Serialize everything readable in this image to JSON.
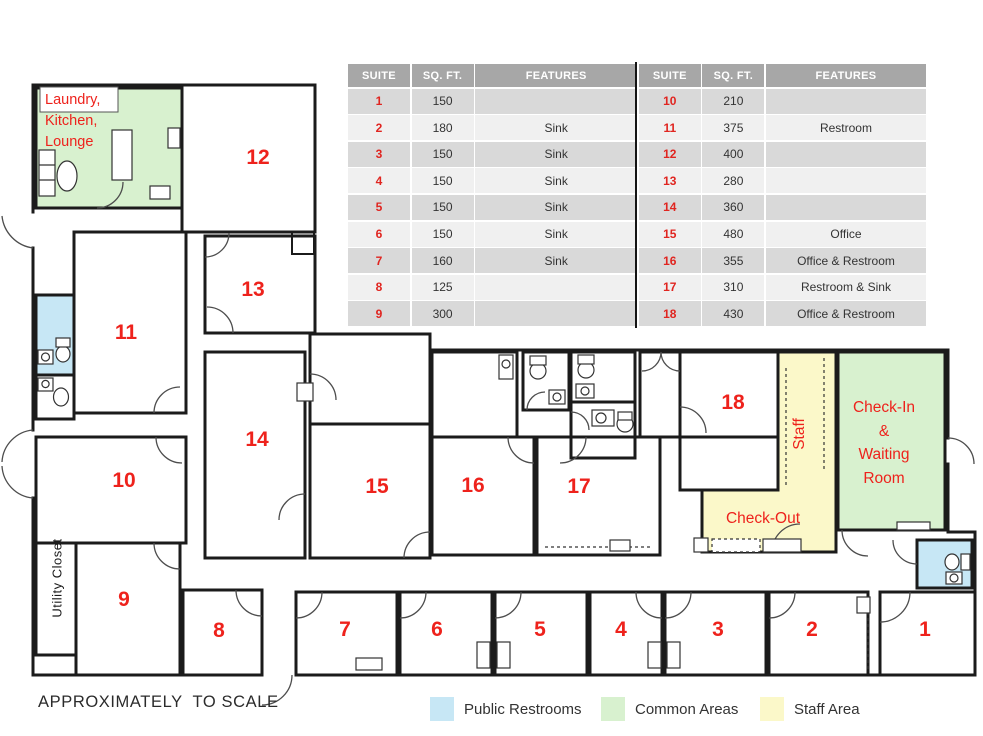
{
  "plan": {
    "suites": {
      "s1": "1",
      "s2": "2",
      "s3": "3",
      "s4": "4",
      "s5": "5",
      "s6": "6",
      "s7": "7",
      "s8": "8",
      "s9": "9",
      "s10": "10",
      "s11": "11",
      "s12": "12",
      "s13": "13",
      "s14": "14",
      "s15": "15",
      "s16": "16",
      "s17": "17",
      "s18": "18"
    },
    "labels": {
      "common_room_lines": [
        "Laundry,",
        "Kitchen,",
        "Lounge"
      ],
      "check_in_lines": [
        "Check-In",
        "&",
        "Waiting",
        "Room"
      ],
      "check_out": "Check-Out",
      "staff": "Staff",
      "utility_closet": "Utility Closet"
    },
    "footer_note": "APPROXIMATELY  TO SCALE"
  },
  "suite_table": {
    "headers": [
      "SUITE",
      "SQ. FT.",
      "FEATURES"
    ],
    "left_rows": [
      {
        "suite": "1",
        "sqft": "150",
        "features": ""
      },
      {
        "suite": "2",
        "sqft": "180",
        "features": "Sink"
      },
      {
        "suite": "3",
        "sqft": "150",
        "features": "Sink"
      },
      {
        "suite": "4",
        "sqft": "150",
        "features": "Sink"
      },
      {
        "suite": "5",
        "sqft": "150",
        "features": "Sink"
      },
      {
        "suite": "6",
        "sqft": "150",
        "features": "Sink"
      },
      {
        "suite": "7",
        "sqft": "160",
        "features": "Sink"
      },
      {
        "suite": "8",
        "sqft": "125",
        "features": ""
      },
      {
        "suite": "9",
        "sqft": "300",
        "features": ""
      }
    ],
    "right_rows": [
      {
        "suite": "10",
        "sqft": "210",
        "features": ""
      },
      {
        "suite": "11",
        "sqft": "375",
        "features": "Restroom"
      },
      {
        "suite": "12",
        "sqft": "400",
        "features": ""
      },
      {
        "suite": "13",
        "sqft": "280",
        "features": ""
      },
      {
        "suite": "14",
        "sqft": "360",
        "features": ""
      },
      {
        "suite": "15",
        "sqft": "480",
        "features": "Office"
      },
      {
        "suite": "16",
        "sqft": "355",
        "features": "Office & Restroom"
      },
      {
        "suite": "17",
        "sqft": "310",
        "features": "Restroom & Sink"
      },
      {
        "suite": "18",
        "sqft": "430",
        "features": "Office & Restroom"
      }
    ]
  },
  "legend": {
    "items": [
      {
        "label": "Public Restrooms",
        "color": "#c7e7f5"
      },
      {
        "label": "Common Areas",
        "color": "#d8f1cf"
      },
      {
        "label": "Staff Area",
        "color": "#fbf8c9"
      }
    ]
  },
  "colors": {
    "suite_number_red": "#ee221c",
    "wall": "#1b1b1b",
    "table_header_gray": "#a7a7a7",
    "table_row_dark": "#d9d9d9",
    "table_row_light": "#f0f0f0"
  }
}
